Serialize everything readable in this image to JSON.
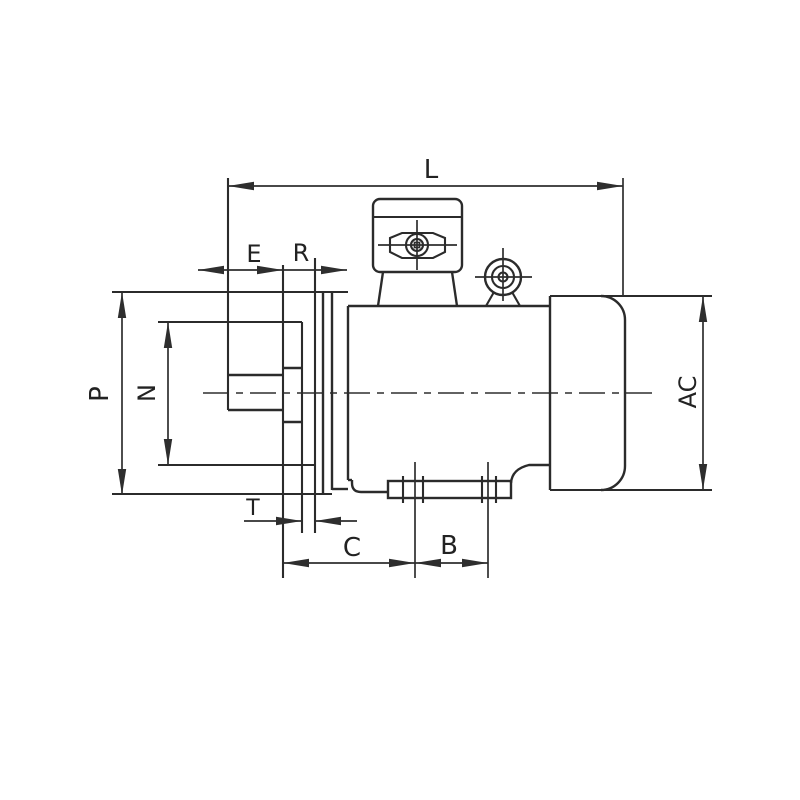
{
  "document": {
    "kind": "technical dimension drawing",
    "subject": "flange-mounted electric motor, side view"
  },
  "colors": {
    "line": "#2b2b2b",
    "background": "#ffffff"
  },
  "dimensions": [
    {
      "id": "L",
      "label": "L"
    },
    {
      "id": "E",
      "label": "E"
    },
    {
      "id": "R",
      "label": "R"
    },
    {
      "id": "P",
      "label": "P"
    },
    {
      "id": "N",
      "label": "N"
    },
    {
      "id": "AC",
      "label": "AC"
    },
    {
      "id": "T",
      "label": "T"
    },
    {
      "id": "C",
      "label": "C"
    },
    {
      "id": "B",
      "label": "B"
    }
  ]
}
